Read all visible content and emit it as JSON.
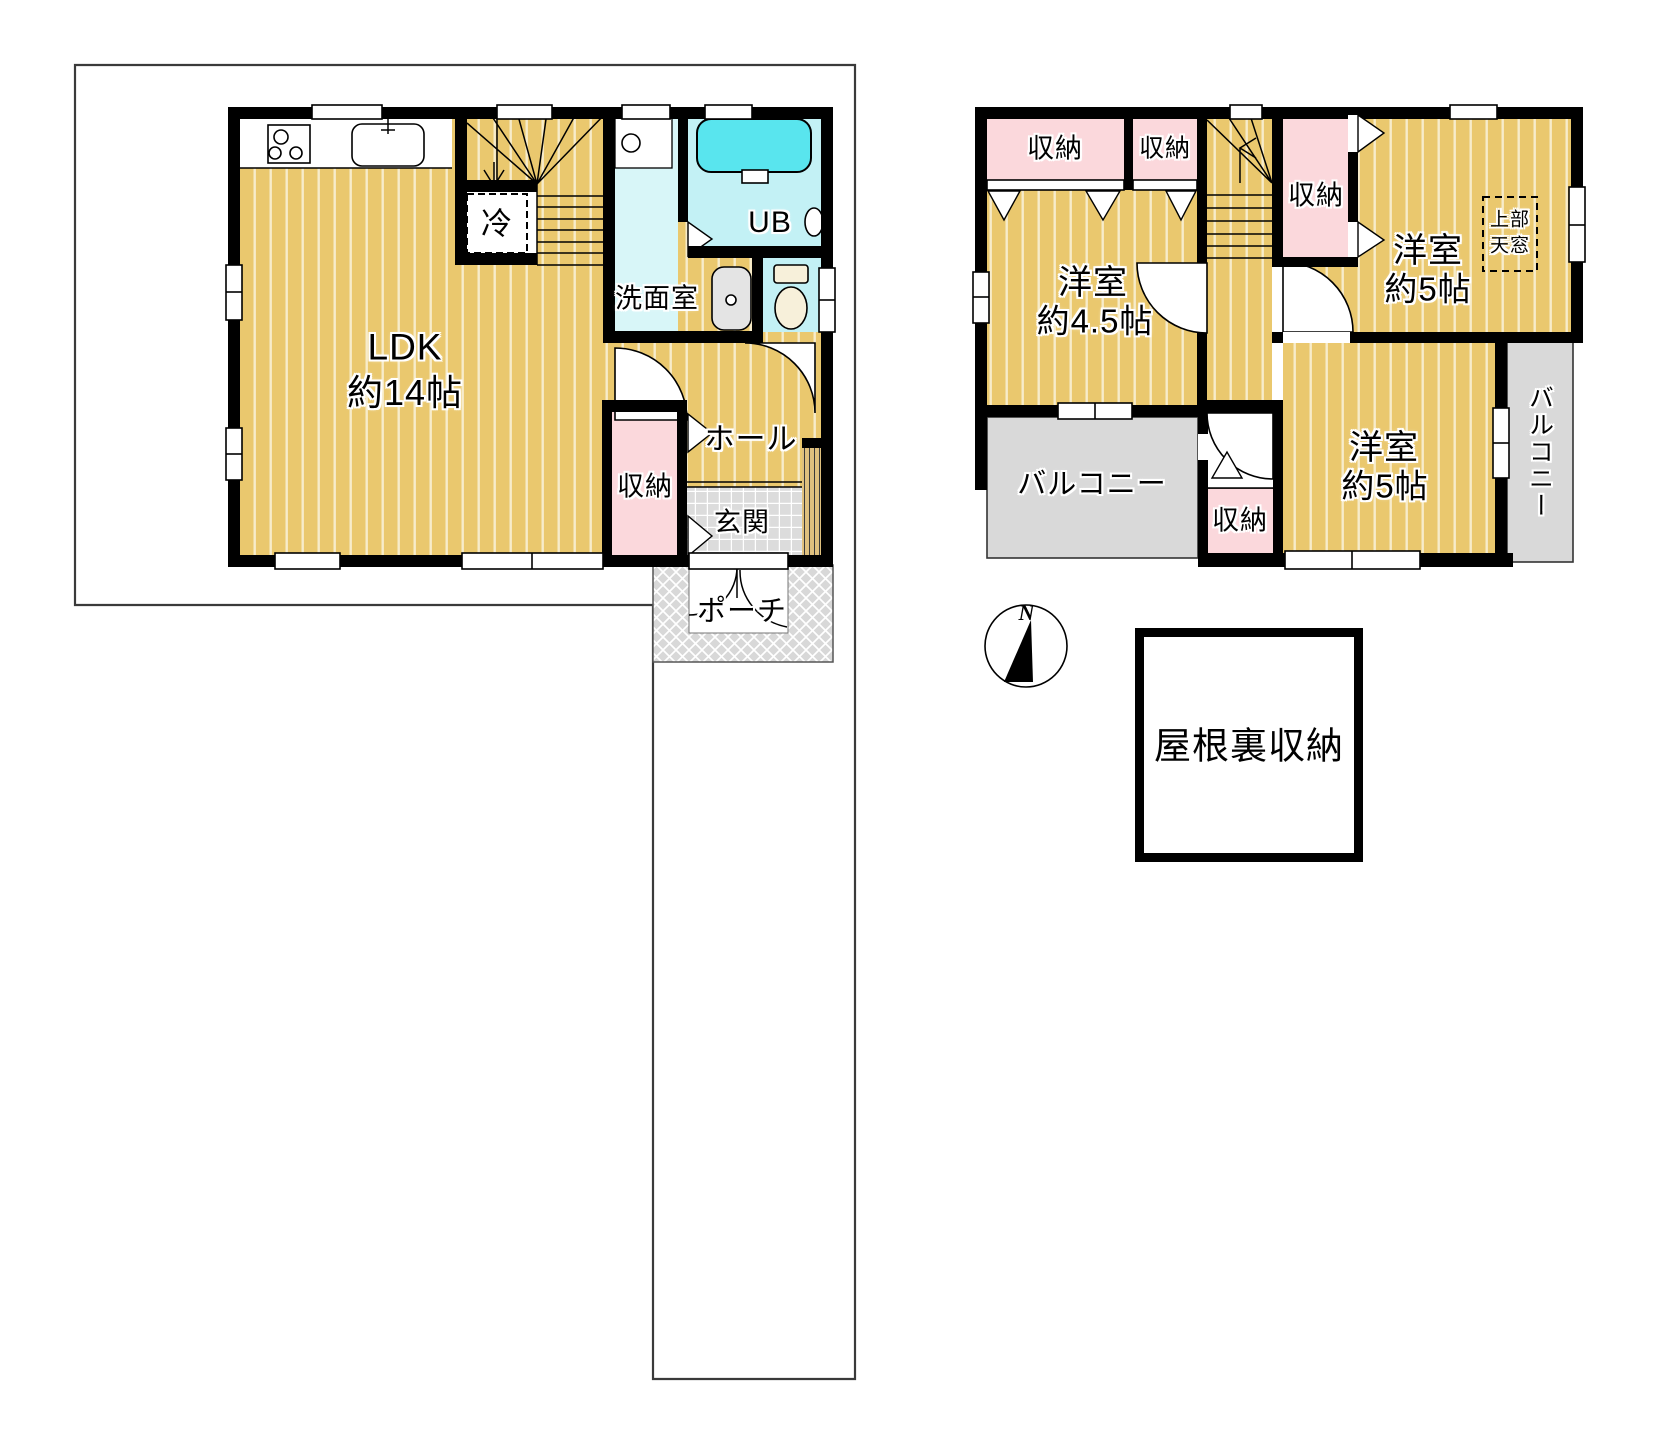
{
  "colors": {
    "floor": "#eac86e",
    "floor_stripe": "#f7ecca",
    "storage_pink": "#fbd8dc",
    "washroom_cyan": "#d8f6f8",
    "bath_cyan": "#c3f1f5",
    "bathtub_cyan": "#59e5ee",
    "balcony_gray": "#d9d9d9",
    "tile_gray": "#dcdcdc",
    "porch_gray": "#d8d8d8",
    "shoe_tan": "#dfc07e",
    "toilet_cream": "#f7f0da",
    "wall_black": "#000000",
    "boundary_gray": "#3a3a3a"
  },
  "floor1": {
    "ldk": {
      "line1": "LDK",
      "line2": "約14帖"
    },
    "refrigerator": "冷",
    "washroom": "洗面室",
    "bath": "UB",
    "hall": "ホール",
    "storage": "収納",
    "entrance": "玄関",
    "porch": "ポーチ"
  },
  "floor2": {
    "storage_nw": "収納",
    "storage_n": "収納",
    "storage_e": "収納",
    "storage_s": "収納",
    "bedroom_w": {
      "line1": "洋室",
      "line2": "約4.5帖"
    },
    "bedroom_ne": {
      "line1": "洋室",
      "line2": "約5帖"
    },
    "bedroom_se": {
      "line1": "洋室",
      "line2": "約5帖"
    },
    "balcony_w": "バルコニー",
    "balcony_e": "バルコニー",
    "skylight": {
      "line1": "上部",
      "line2": "天窓"
    }
  },
  "attic": {
    "label": "屋根裏収納"
  },
  "compass": {
    "north": "N"
  }
}
